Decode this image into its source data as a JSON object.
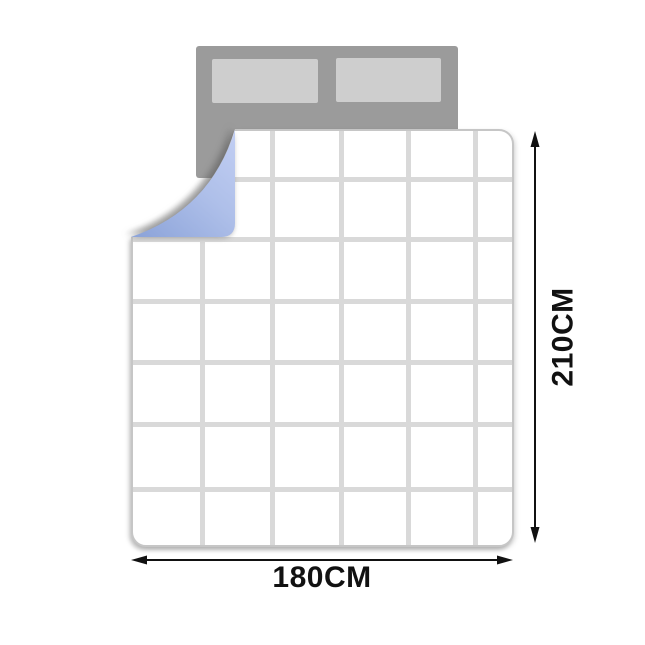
{
  "diagram": {
    "description": "Duvet size diagram on bed with headboard and pillows; folded corner reveals blue underside",
    "colors": {
      "bg": "#ffffff",
      "headboard": "#9b9b9b",
      "pillow": "#cecece",
      "quilt": "#ffffff",
      "quilt_border": "#c6c6c6",
      "grid": "#d9d9d9",
      "fold_light": "#c0cdf2",
      "fold_mid": "#aebfe9",
      "fold_dark": "#8ea5da",
      "arrow": "#111111"
    },
    "bed": {
      "pillow_count": 2
    },
    "blanket": {
      "grid": {
        "v": [
          67,
          137,
          206,
          273,
          340
        ],
        "h": [
          46,
          106,
          168,
          229,
          291,
          356
        ],
        "thickness": 5
      }
    },
    "dimensions": {
      "width": {
        "label": "180CM"
      },
      "height": {
        "label": "210CM"
      }
    }
  }
}
